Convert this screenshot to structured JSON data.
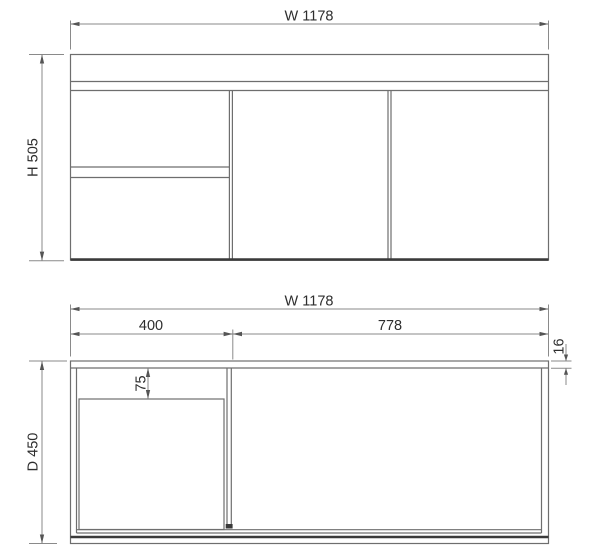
{
  "drawing": {
    "type": "cabinet-dimension-drawing",
    "front_view": {
      "width_label": "W 1178",
      "height_label": "H 505"
    },
    "plan_view": {
      "width_label": "W 1178",
      "left_width_label": "400",
      "right_width_label": "778",
      "panel_thickness_label": "16",
      "offset_label": "75",
      "depth_label": "D 450"
    },
    "colors": {
      "background": "#ffffff",
      "line": "#6e6e6e",
      "line_dark": "#3a3a3a",
      "dimension_line": "#8a8a8a",
      "text": "#2e2e2e"
    }
  }
}
